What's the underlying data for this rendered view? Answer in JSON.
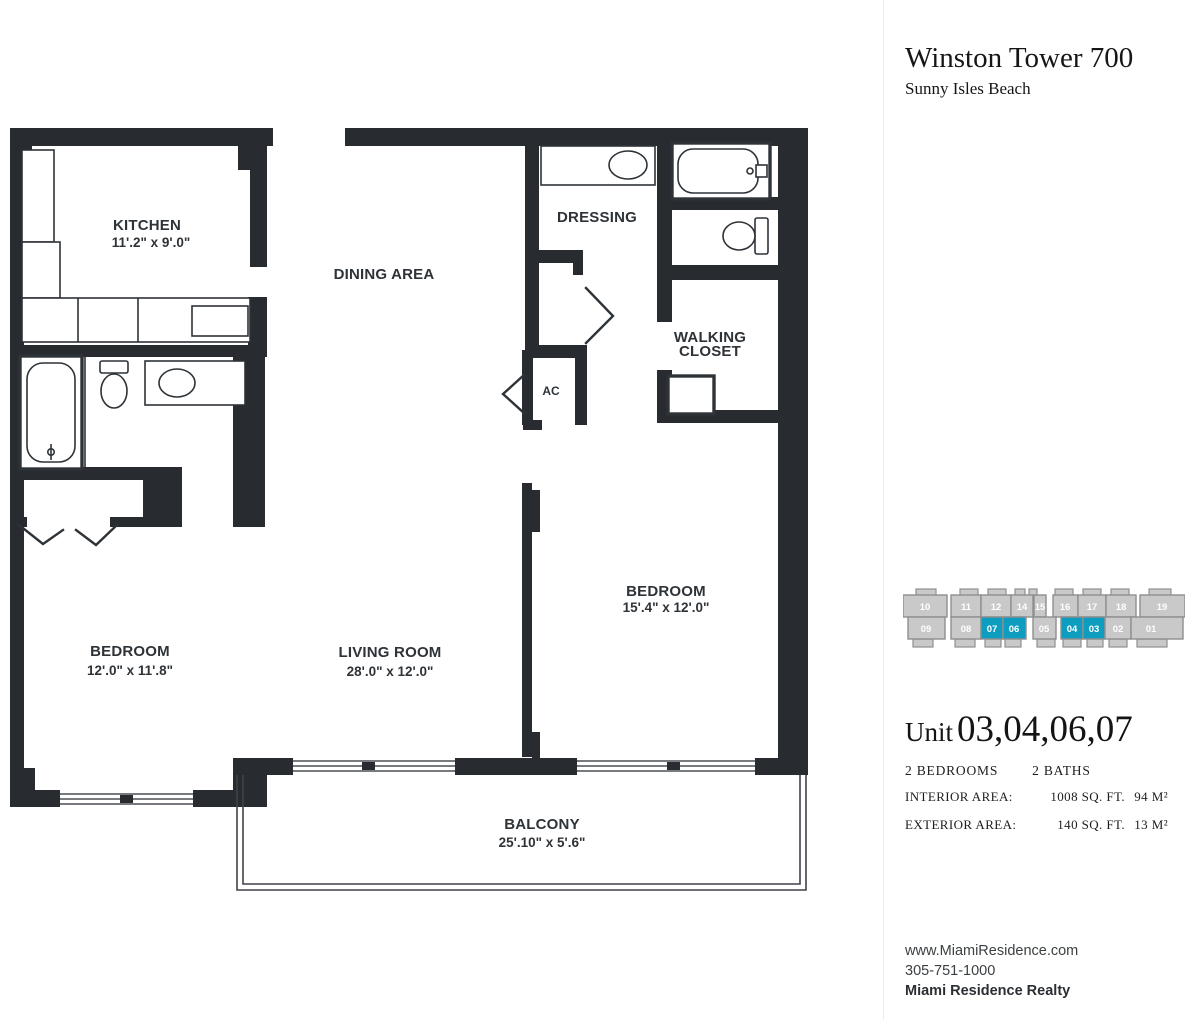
{
  "header": {
    "title": "Winston Tower 700",
    "subtitle": "Sunny Isles Beach"
  },
  "rooms": {
    "kitchen": {
      "label": "KITCHEN",
      "dims": "11'.2\" x 9'.0\""
    },
    "dining": {
      "label": "DINING AREA"
    },
    "dressing": {
      "label": "DRESSING"
    },
    "walking_closet": {
      "label_line1": "WALKING",
      "label_line2": "CLOSET"
    },
    "ac": {
      "label": "AC"
    },
    "bedroom_right": {
      "label": "BEDROOM",
      "dims": "15'.4\" x 12'.0\""
    },
    "bedroom_left": {
      "label": "BEDROOM",
      "dims": "12'.0\" x 11'.8\""
    },
    "living_room": {
      "label": "LIVING ROOM",
      "dims": "28'.0\" x 12'.0\""
    },
    "balcony": {
      "label": "BALCONY",
      "dims": "25'.10\" x 5'.6\""
    }
  },
  "unit_map": {
    "highlight_color": "#0d9dc1",
    "block_color": "#c9c9c9",
    "top": [
      {
        "label": "10",
        "selected": false
      },
      {
        "label": "11",
        "selected": false
      },
      {
        "label": "12",
        "selected": false
      },
      {
        "label": "14",
        "selected": false
      },
      {
        "label": "15",
        "selected": false
      },
      {
        "label": "16",
        "selected": false
      },
      {
        "label": "17",
        "selected": false
      },
      {
        "label": "18",
        "selected": false
      },
      {
        "label": "19",
        "selected": false
      }
    ],
    "bottom": [
      {
        "label": "09",
        "selected": false
      },
      {
        "label": "08",
        "selected": false
      },
      {
        "label": "07",
        "selected": true
      },
      {
        "label": "06",
        "selected": true
      },
      {
        "label": "05",
        "selected": false
      },
      {
        "label": "04",
        "selected": true
      },
      {
        "label": "03",
        "selected": true
      },
      {
        "label": "02",
        "selected": false
      },
      {
        "label": "01",
        "selected": false
      }
    ]
  },
  "unit_info": {
    "unit_label": "Unit",
    "unit_numbers": "03,04,06,07",
    "beds": "2 BEDROOMS",
    "baths": "2 BATHS",
    "areas": [
      {
        "label": "INTERIOR AREA:",
        "sqft": "1008 SQ. FT.",
        "metric": "94 M²"
      },
      {
        "label": "EXTERIOR AREA:",
        "sqft": "140 SQ. FT.",
        "metric": "13 M²"
      }
    ]
  },
  "footer": {
    "website": "www.MiamiResidence.com",
    "phone": "305-751-1000",
    "company": "Miami Residence Realty"
  }
}
